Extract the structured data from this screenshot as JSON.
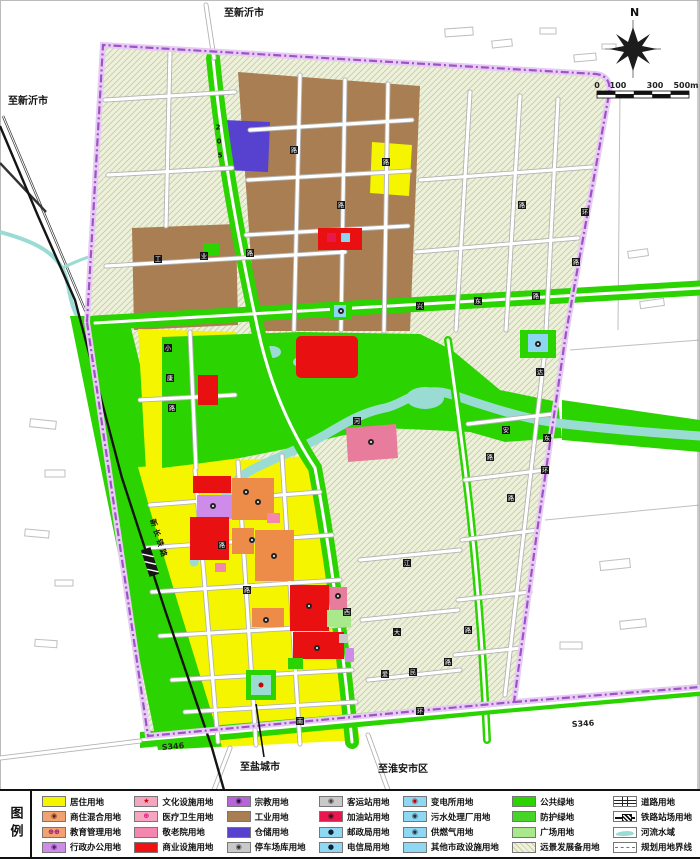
{
  "colors": {
    "residential_yellow": "#F5F500",
    "mixed_orange": "#EC8C48",
    "admin_violet": "#CE8BEA",
    "culture_pink": "#F4A6BE",
    "hospital_rose": "#E87C9C",
    "nursing_pink": "#F487AE",
    "commercial_red": "#E81010",
    "industry_brown": "#A87E52",
    "warehouse_blue": "#5742CF",
    "municipal_lightblue": "#8CD6F2",
    "public_green": "#2BD400",
    "plaza_green": "#A9E98C",
    "reserve_hatch_bg": "#EDF0DB",
    "river_cyan": "#9ADCD4",
    "boundary_purple": "#A050C8"
  },
  "map": {
    "labels": {
      "to_xinyi_top": "至新沂市",
      "to_xinyi_left": "至新沂市",
      "to_yancheng": "至盐城市",
      "to_huaian": "至淮安市区",
      "s346_left": "S346",
      "s346_right": "S346",
      "railway": "新长铁路",
      "north": "N"
    },
    "scalebar": {
      "ticks": [
        "0",
        "100",
        "300",
        "500m"
      ]
    },
    "road_chips": [
      {
        "c": "2",
        "x": 218,
        "y": 127,
        "t": "plain"
      },
      {
        "c": "0",
        "x": 219,
        "y": 141,
        "t": "plain"
      },
      {
        "c": "5",
        "x": 220,
        "y": 155,
        "t": "plain"
      },
      {
        "c": "工",
        "x": 158,
        "y": 259
      },
      {
        "c": "业",
        "x": 204,
        "y": 256
      },
      {
        "c": "路",
        "x": 250,
        "y": 253
      },
      {
        "c": "路",
        "x": 294,
        "y": 150
      },
      {
        "c": "路",
        "x": 341,
        "y": 205
      },
      {
        "c": "路",
        "x": 386,
        "y": 162
      },
      {
        "c": "兴",
        "x": 420,
        "y": 306
      },
      {
        "c": "东",
        "x": 478,
        "y": 301
      },
      {
        "c": "路",
        "x": 536,
        "y": 296
      },
      {
        "c": "环",
        "x": 585,
        "y": 212
      },
      {
        "c": "路",
        "x": 576,
        "y": 262
      },
      {
        "c": "路",
        "x": 522,
        "y": 205
      },
      {
        "c": "环",
        "x": 545,
        "y": 470
      },
      {
        "c": "达",
        "x": 540,
        "y": 372
      },
      {
        "c": "安",
        "x": 506,
        "y": 430
      },
      {
        "c": "东",
        "x": 547,
        "y": 438
      },
      {
        "c": "路",
        "x": 490,
        "y": 457
      },
      {
        "c": "路",
        "x": 511,
        "y": 498
      },
      {
        "c": "江",
        "x": 407,
        "y": 563
      },
      {
        "c": "河",
        "x": 357,
        "y": 421
      },
      {
        "c": "小",
        "x": 168,
        "y": 348
      },
      {
        "c": "康",
        "x": 170,
        "y": 378
      },
      {
        "c": "路",
        "x": 172,
        "y": 408
      },
      {
        "c": "西",
        "x": 347,
        "y": 612
      },
      {
        "c": "大",
        "x": 397,
        "y": 632
      },
      {
        "c": "路",
        "x": 468,
        "y": 630
      },
      {
        "c": "爱",
        "x": 385,
        "y": 674
      },
      {
        "c": "民",
        "x": 413,
        "y": 672
      },
      {
        "c": "路",
        "x": 448,
        "y": 662
      },
      {
        "c": "南",
        "x": 300,
        "y": 721
      },
      {
        "c": "环",
        "x": 420,
        "y": 711
      },
      {
        "c": "路",
        "x": 247,
        "y": 590
      },
      {
        "c": "路",
        "x": 222,
        "y": 545
      }
    ]
  },
  "legend": {
    "title": "图例",
    "columns": [
      [
        {
          "label": "居住用地",
          "fill": "#F5F500"
        },
        {
          "label": "商住混合用地",
          "fill": "#F2A26E",
          "icon": "◉",
          "ic": "#5a2a10"
        },
        {
          "label": "教育管理用地",
          "fill": "#F2A26E",
          "icon": "⊕⊕",
          "ic": "#8b008b"
        },
        {
          "label": "行政办公用地",
          "fill": "#CE8BEA",
          "icon": "◉",
          "ic": "#4b1d6e"
        }
      ],
      [
        {
          "label": "文化设施用地",
          "fill": "#F4A6BE",
          "icon": "★",
          "ic": "#d40000"
        },
        {
          "label": "医疗卫生用地",
          "fill": "#F4A6BE",
          "icon": "⊕",
          "ic": "#e0007f"
        },
        {
          "label": "敬老院用地",
          "fill": "#F487AE"
        },
        {
          "label": "商业设施用地",
          "fill": "#EE1212"
        }
      ],
      [
        {
          "label": "宗教用地",
          "fill": "#B565D8",
          "icon": "◉",
          "ic": "#2a0a3a"
        },
        {
          "label": "工业用地",
          "fill": "#A87E52"
        },
        {
          "label": "仓储用地",
          "fill": "#5742CF"
        },
        {
          "label": "停车场库用地",
          "fill": "#C9C9C9",
          "icon": "◉",
          "ic": "#333333"
        }
      ],
      [
        {
          "label": "客运站用地",
          "fill": "#C9C9C9",
          "icon": "◉",
          "ic": "#444444"
        },
        {
          "label": "加油站用地",
          "fill": "#E8174E",
          "icon": "◉",
          "ic": "#1a1a1a"
        },
        {
          "label": "邮政局用地",
          "fill": "#8FD8F4",
          "icon": "●",
          "ic": "#102030"
        },
        {
          "label": "电信局用地",
          "fill": "#8FD8F4",
          "icon": "●",
          "ic": "#102030"
        }
      ],
      [
        {
          "label": "变电所用地",
          "fill": "#8FD8F4",
          "icon": "◉",
          "ic": "#c00000"
        },
        {
          "label": "污水处理厂用地",
          "fill": "#8FD8F4",
          "icon": "◉",
          "ic": "#203040"
        },
        {
          "label": "供燃气用地",
          "fill": "#8FD8F4",
          "icon": "◉",
          "ic": "#203040"
        },
        {
          "label": "其他市政设施用地",
          "fill": "#8FD8F4"
        }
      ],
      [
        {
          "label": "公共绿地",
          "fill": "#2BD400"
        },
        {
          "label": "防护绿地",
          "fill": "#46D428"
        },
        {
          "label": "广场用地",
          "fill": "#A9E98C"
        },
        {
          "label": "远景发展备用地",
          "type": "hatch"
        }
      ],
      [
        {
          "label": "道路用地",
          "type": "road"
        },
        {
          "label": "铁路站场用地",
          "type": "rail"
        },
        {
          "label": "河流水域",
          "type": "river"
        },
        {
          "label": "规划用地界线",
          "type": "dashline"
        }
      ]
    ]
  }
}
